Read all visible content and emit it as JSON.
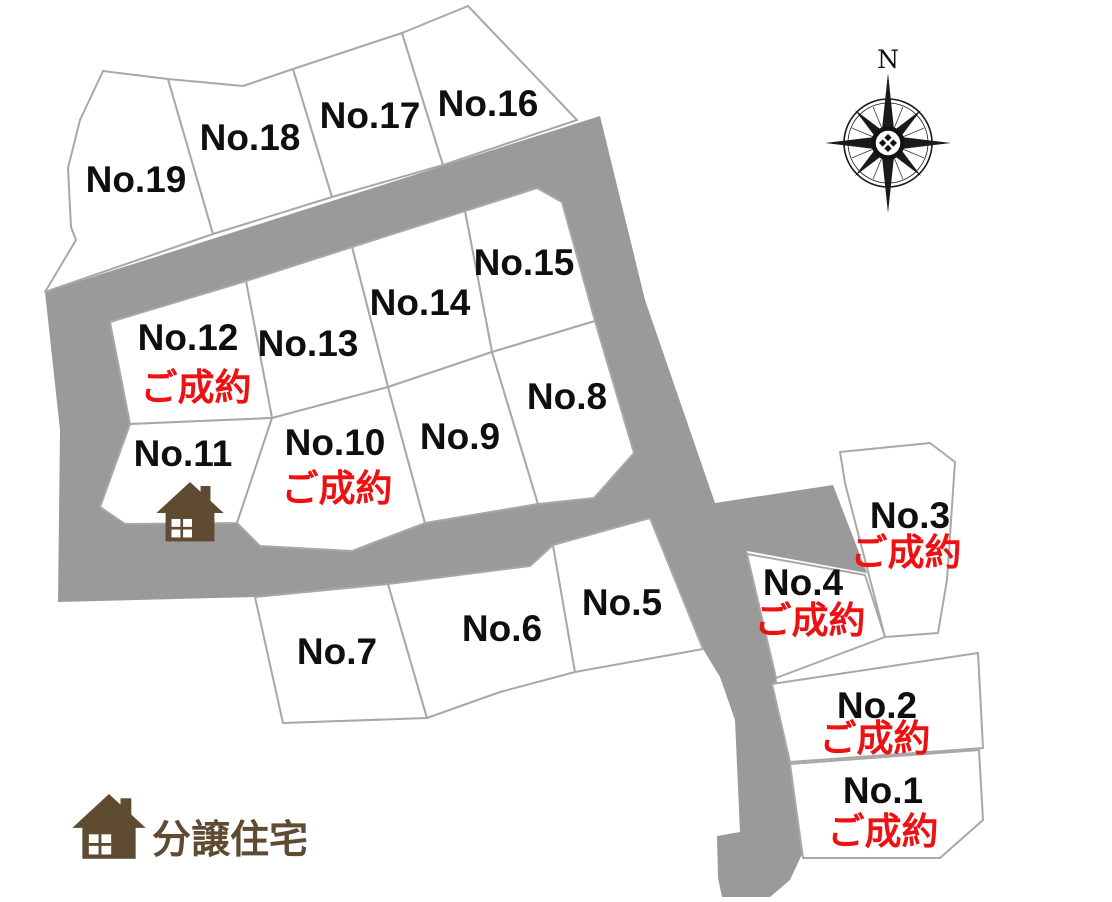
{
  "map": {
    "title": "分譲地 区画図",
    "sold_label": "ご成約",
    "legend": {
      "label": "分譲住宅",
      "icon": "house-icon"
    },
    "compass": {
      "label": "N",
      "icon": "compass-rose-icon"
    },
    "colors": {
      "road": "#9a9a9a",
      "lot_border": "#a8a8a8",
      "lot_fill": "#ffffff",
      "sold_red": "#ee1111",
      "house_brown": "#5f4b31",
      "label_black": "#0f0f0f"
    },
    "house_icons_on": [
      "No.11"
    ],
    "lots": [
      {
        "label": "No.1",
        "sold": true
      },
      {
        "label": "No.2",
        "sold": true
      },
      {
        "label": "No.3",
        "sold": true
      },
      {
        "label": "No.4",
        "sold": true
      },
      {
        "label": "No.5",
        "sold": false
      },
      {
        "label": "No.6",
        "sold": false
      },
      {
        "label": "No.7",
        "sold": false
      },
      {
        "label": "No.8",
        "sold": false
      },
      {
        "label": "No.9",
        "sold": false
      },
      {
        "label": "No.10",
        "sold": true
      },
      {
        "label": "No.11",
        "sold": false
      },
      {
        "label": "No.12",
        "sold": true
      },
      {
        "label": "No.13",
        "sold": false
      },
      {
        "label": "No.14",
        "sold": false
      },
      {
        "label": "No.15",
        "sold": false
      },
      {
        "label": "No.16",
        "sold": false
      },
      {
        "label": "No.17",
        "sold": false
      },
      {
        "label": "No.18",
        "sold": false
      },
      {
        "label": "No.19",
        "sold": false
      }
    ]
  }
}
